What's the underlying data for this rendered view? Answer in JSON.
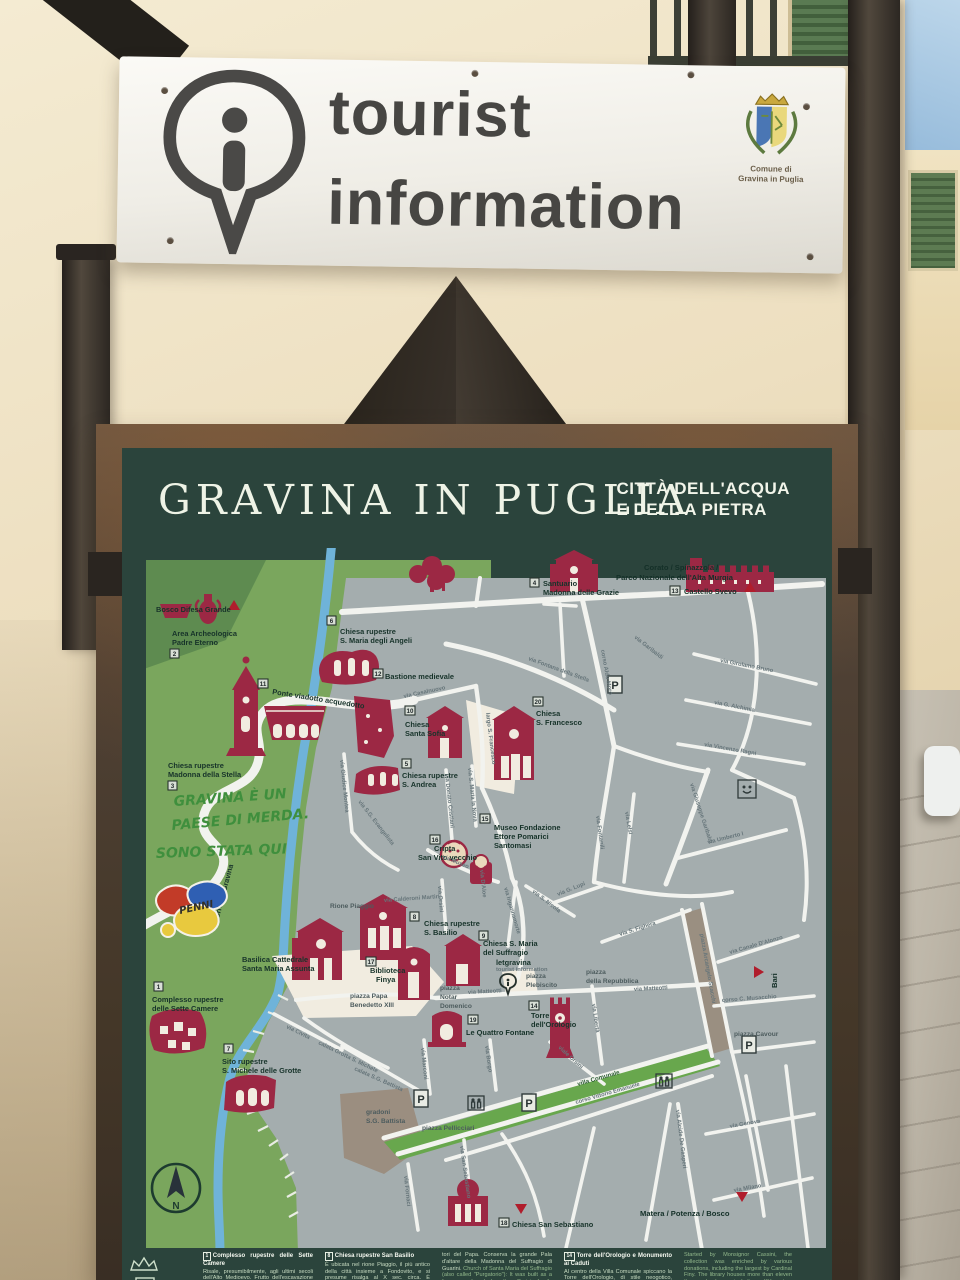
{
  "sign": {
    "line1": "tourist",
    "line2": "information",
    "crest1": "Comune di",
    "crest2": "Gravina in Puglia"
  },
  "board": {
    "title": "GRAVINA IN PUGLIA",
    "subtitle1": "CITTÀ DELL'ACQUA",
    "subtitle2": "E DELL A PIETRA"
  },
  "map": {
    "parking": "P",
    "compass_n": "N",
    "bosco": "Bosco Difesa Grande",
    "area1": "Area Archeologica",
    "area2": "Padre Eterno",
    "stella1": "Chiesa rupestre",
    "stella2": "Madonna della Stella",
    "angeli1": "Chiesa rupestre",
    "angeli2": "S. Maria degli Angeli",
    "ponte": "Ponte viadotto acquedotto",
    "bastione": "Bastione medievale",
    "sofia1": "Chiesa",
    "sofia2": "Santa Sofia",
    "andrea1": "Chiesa rupestre",
    "andrea2": "S. Andrea",
    "francesco1": "Chiesa",
    "francesco2": "S. Francesco",
    "santuario1": "Santuario",
    "santuario2": "Madonna delle Grazie",
    "corato1": "Corato  / Spinazzola /",
    "corato2": "Parco Nazionale dell'Alta Murgia",
    "castello": "Castello Svevo",
    "cripta1": "Cripta",
    "cripta2": "San Vito vecchio",
    "museo1": "Museo Fondazione",
    "museo2": "Ettore Pomarici",
    "museo3": "Santomasi",
    "rione": "Rione Piaggio",
    "basilica1": "Basilica Cattedrale",
    "basilica2": "Santa Maria Assunta",
    "biblio1": "Biblioteca",
    "biblio2": "Finya",
    "papa1": "piazza Papa",
    "papa2": "Benedetto XIII",
    "notar1": "piazza",
    "notar2": "Notar",
    "notar3": "Domenico",
    "suffragio1": "Chiesa S. Maria",
    "suffragio2": "del Suffragio",
    "basilio1": "Chiesa rupestre",
    "basilio2": "S. Basilio",
    "infopoint1": "letgravina",
    "infopoint2": "tourist information",
    "plebiscito1": "piazza",
    "plebiscito2": "Plebiscito",
    "repubblica1": "piazza",
    "repubblica2": "della Repubblica",
    "quattro": "Le Quattro Fontane",
    "torre1": "Torre",
    "torre2": "dell'Orologio",
    "cavour": "piazza Cavour",
    "bari": "Bari",
    "matera": "Matera / Potenza / Bosco",
    "sette1": "Complesso rupestre",
    "sette2": "delle Sette Camere",
    "sito1": "Sito rupestre",
    "sito2": "S. Michele delle Grotte",
    "sanseb": "Chiesa San Sebastiano",
    "gradoni1": "gradoni",
    "gradoni2": "S.G. Battista",
    "pellicciari": "piazza Pellicciari",
    "villa": "villa Comunale",
    "torrente": "Torrente Gravina",
    "graffiti1": "GRAVINA È UN",
    "graffiti2": "PAESE DI MERDA.",
    "graffiti3": "SONO STATA QUI",
    "sticker": "PENNI",
    "streets": {
      "casalnuovo": "via Casalnuovo",
      "fontana": "via Fontana della Stella",
      "aldomoro": "corso Aldo Moro",
      "garibaldi_n": "via Garibaldi",
      "girolamo": "via Girolamo Bruno",
      "alchimia": "via G. Alchimia",
      "ragni": "via Vincenzo Ragni",
      "largosf": "largo S. Francesco",
      "giudice": "via Giudice Montea",
      "evangelista": "via S.G. Evangelista",
      "cristiani": "via Donato Cristiani",
      "marianova": "via S. Maria la Nova",
      "museo": "via Museo",
      "orsini": "via Orsini",
      "calderoni": "via Calderoni Martiri",
      "fontanili": "via Fontanili",
      "glupi": "via G. Lupi",
      "snicola": "via S. Nicola",
      "inganna": "via Ingannamorte",
      "daloe": "via D'Aloe",
      "lelsi": "via Lelsi",
      "garibaldi": "via Giuseppe Garibaldi",
      "umberto": "via Umberto I",
      "fighera": "via S. Fighera",
      "canale": "via Canale D'Alonzo",
      "musacchio": "corso C. Musacchio",
      "scacchi": "piazza Arcangelo Scacchi",
      "matteotti": "via Matteotti",
      "liberta": "via Libertà",
      "vleorsini": "viale Orsini",
      "corsove": "corso Vittorio Emanuele",
      "borgo": "via Borgo",
      "marconi": "via Marconi",
      "civita": "via Civita",
      "calata1": "calata Grotta S. Michele",
      "calata2": "calata S.G. Battista",
      "sanseb": "via San Sebastiano",
      "fornaci": "via Fornaci",
      "gasperi": "via Alcide De Gasperi",
      "genova": "via Genova",
      "milano": "via Milano"
    },
    "nums": {
      "b1": "1",
      "b2": "2",
      "b3": "3",
      "b4": "4",
      "b5": "5",
      "b6": "6",
      "b7": "7",
      "b8": "8",
      "b9": "9",
      "b10": "10",
      "b11": "11",
      "b12": "12",
      "b13": "13",
      "b14": "14",
      "b15": "15",
      "b16": "16",
      "b17": "17",
      "b18": "18",
      "b19": "19",
      "b20": "20"
    }
  },
  "legend": {
    "c1": {
      "num": "1",
      "title": "Complesso rupestre delle Sette Camere",
      "body": "Risale, presumibilmente, agli ultimi secoli dell'Alto Medioevo. Frutto dell'escavazione artificiale in un banco di tufo sul versante ovest della gravina, si articola in diversi vani.",
      "en": "The rupestrian complex of the Seven Chambers: Presumably dating to the last centuries of"
    },
    "c2": {
      "num": "8",
      "title": "Chiesa rupestre San Basilio",
      "body": "È ubicata nel rione Piaggio, il più antico della città insieme a Fondovito, e si presume risalga al X sec. circa. È suddivisa in quattro navate da pilastri e da colonne irregolari e presenta l'abside originale collocato lateralmente all'ingresso.",
      "en": "San Basilio rupestrian church: The church is"
    },
    "c3": {
      "body": "tori del Papa. Conserva la grande Pala d'altare della Madonna del Suffragio di Guarini.",
      "en": "Church of Santa Maria del Suffragio (also called \"Purgatorio\"): It was built as a funerary chapel by the Orsini family between 1649 and 1654 and commissioned by the Orsini Dukes of Gravina, the Pope's parents. Inside you can ad-"
    },
    "c4": {
      "num": "14",
      "title": "Torre dell'Orologio e Monumento ai Caduti",
      "body": "Al centro della Villa Comunale spiccano la Torre dell'Orologio, di stile neogotico, costruita sulla cinta muraria nei pressi del Palazzo Ducale degli Orsini, con orologio del 1893 della Ditta Curci di Napoli, e il Monumento bronzeo ai Caduti della"
    },
    "c5": {
      "en": "Started by Monsignor Cassini, the collection was enriched by various donations, including the largest by Cardinal Finy. The library houses more than eleven thousand volumes, including a XV century manuscript, 14 incunabula, and 363 XVI century books."
    }
  },
  "colors": {
    "board_green": "#2b443c",
    "map_green": "#7aa65d",
    "urban_gray": "#a4adae",
    "monument_maroon": "#9c2844",
    "river_blue": "#6fb3d9",
    "direction_red": "#b01d2c"
  }
}
